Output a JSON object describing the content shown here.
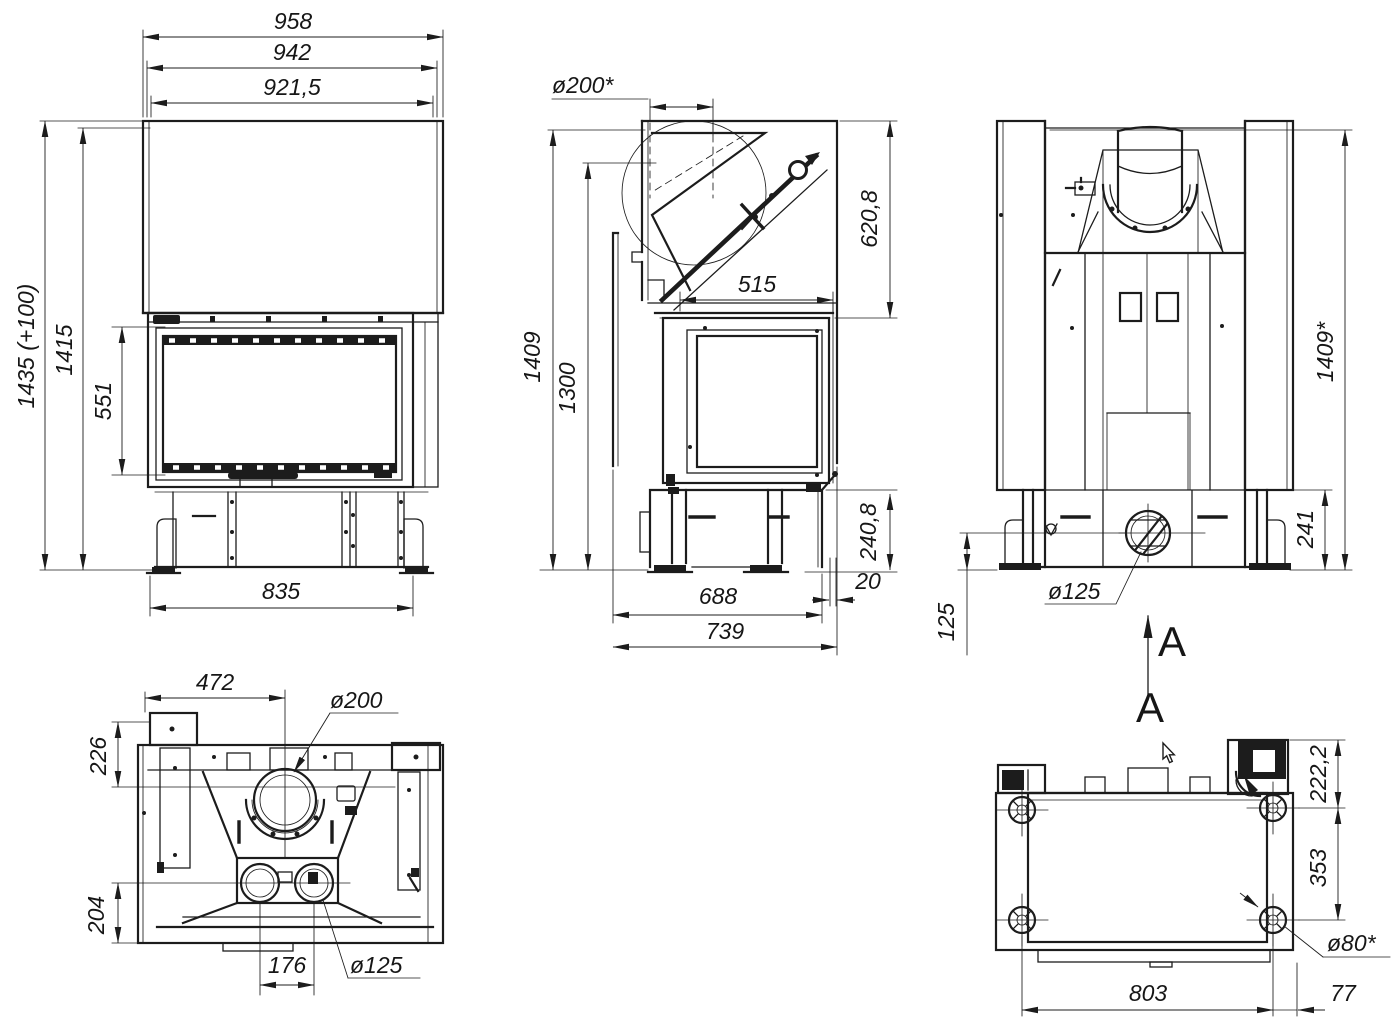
{
  "dims": {
    "front": {
      "width_top": "958",
      "width_mid": "942",
      "width_inner": "921,5",
      "height_total": "1435 (+100)",
      "height_body": "1415",
      "glass_height": "551",
      "base_width": "835"
    },
    "side": {
      "flue_diameter": "ø200*",
      "hood_height": "620,8",
      "side_glass_width": "515",
      "height_total": "1409",
      "height_front": "1300",
      "base_height": "240,8",
      "rear_gap": "20",
      "depth_base": "688",
      "depth_total": "739"
    },
    "back": {
      "height_total": "1409*",
      "base_height": "241",
      "outlet_height": "125",
      "outlet_diameter": "ø125",
      "section_label": "A"
    },
    "top": {
      "width_left": "472",
      "flue_diameter": "ø200",
      "front_offset": "226",
      "rear_offset": "204",
      "duct_spacing": "176",
      "duct_diameter": "ø125"
    },
    "bottom": {
      "top_offset": "222,2",
      "foot_spacing_depth": "353",
      "foot_diameter": "ø80*",
      "foot_spacing_width": "803",
      "side_offset": "77"
    }
  }
}
